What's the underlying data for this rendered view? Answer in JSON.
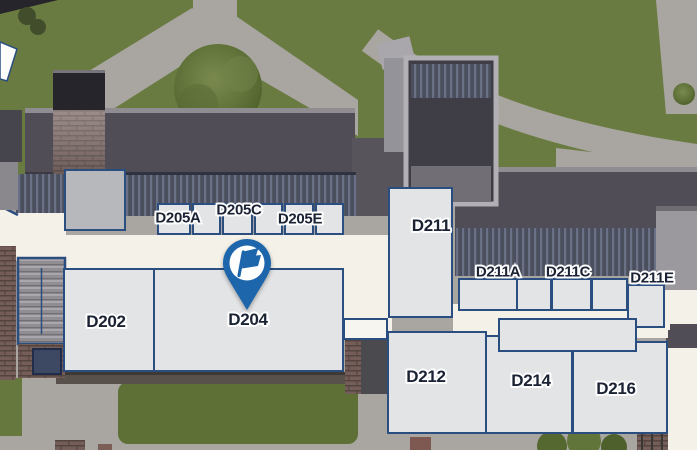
{
  "map": {
    "type": "campus-floor-map",
    "marker": {
      "attached_room": "D204",
      "icon": "flag-icon"
    },
    "rooms": {
      "d202": "D202",
      "d204": "D204",
      "d205a": "D205A",
      "d205c": "D205C",
      "d205e": "D205E",
      "d211": "D211",
      "d211a": "D211A",
      "d211c": "D211C",
      "d211e": "D211E",
      "d212": "D212",
      "d214": "D214",
      "d216": "D216"
    },
    "colors": {
      "grass": "#6a7b41",
      "path": "#a9a6a1",
      "corridor": "#f4f1e9",
      "room_fill": "#e3e4e6",
      "room_border": "#2b4e80",
      "roof_dark": "#504d56",
      "roof_light": "#9b999d",
      "brick": "#755e59",
      "pin_blue": "#1d66ab",
      "label_text": "#1a2233"
    }
  }
}
